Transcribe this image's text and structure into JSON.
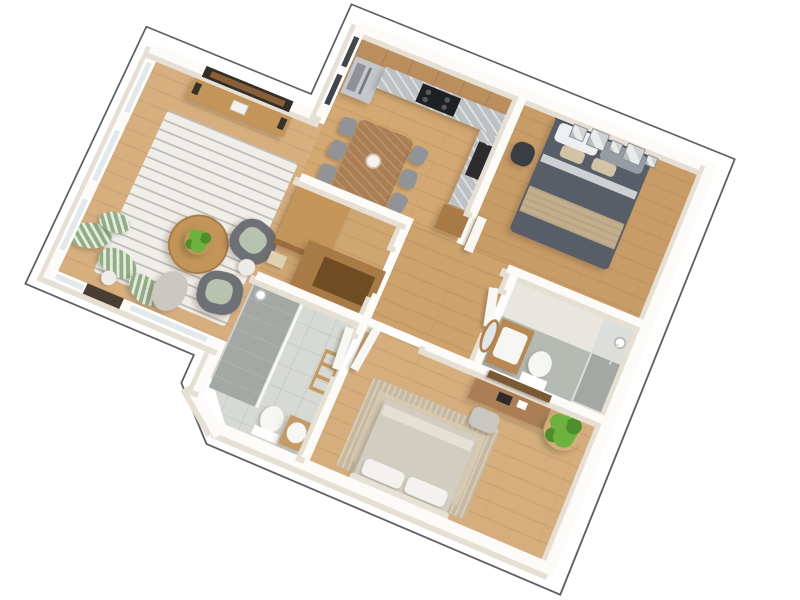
{
  "scene": {
    "type": "isometric-3d-floorplan-render",
    "description": "3D cutaway floor plan of a two-bedroom apartment viewed from above, white walls and oak floors on a plain white background, thin gray outline offset around the building perimeter",
    "view": {
      "plan_rotation_deg": 23,
      "tilt_deg": 12
    },
    "text_labels": []
  },
  "colors": {
    "outline": "#54575b",
    "wall": "#fcfbf8",
    "wall_shade": "#e6dfd4",
    "floor_living": "#d7af7f",
    "floor_kitchen": "#d3a872",
    "floor_hall": "#cda26d",
    "floor_master": "#c89c66",
    "floor_bed2": "#d6ae7d",
    "floor_closet": "#cfa671",
    "tile_light": "#d7d9d4",
    "tile_gray": "#b5bab3",
    "shower_tile": "#a3a8a4",
    "counter_marble": "#bdc1c4",
    "steel": "#c4c7cc",
    "steel_dark": "#8e9298",
    "cooktop": "#1f2022",
    "sink_black": "#2c2c2f",
    "cabinet_wood": "#bb8e5d",
    "wood_mid": "#c39558",
    "wood_deep": "#a87a45",
    "wood_dark": "#6f4c22",
    "table_wood": "#ab7e53",
    "chair_gray": "#909398",
    "rug_living": "#f0eee9",
    "rug_stripe": "#bfbeba",
    "armchair": "#6d7175",
    "cushion_sage": "#b7c3ae",
    "plant_sage": "#8fae85",
    "plant_sage_light": "#e6eadf",
    "pampas": "#cbc8c2",
    "plant_green": "#6db23f",
    "plant_green_dark": "#4e8f2c",
    "bed_master": "#585e67",
    "pillow_gray": "#969ca4",
    "pillow_white": "#edeff0",
    "sheet": "#cdd1d4",
    "blanket": "#c2ad8c",
    "blanket_light": "#d3c3a6",
    "bed2": "#d2ccc1",
    "bed2_fold": "#e5dfd4",
    "pillow2": "#f4f2ee",
    "headboard2": "#e8e2d6",
    "rug2": "#d6cab2",
    "rug2_border": "#c7b99f",
    "porcelain": "#f6f6f3",
    "vanity_wood": "#b88852",
    "mirror_wood": "#b2804a",
    "shelf_dark": "#7a5a33",
    "glass": "#dfe6e8",
    "window_glass": "#e3e9ea",
    "window_dark": "#41464c",
    "door_white": "#f8f7f4",
    "door_dark": "#4a3e33",
    "ladder_wood": "#c69a63",
    "mat_gray": "#c9c7c2",
    "desk_item": "#2e2c29",
    "accent_chair_dark": "#3a3d41"
  },
  "rooms": [
    {
      "id": "living-room",
      "position": "left wing",
      "features": [
        "panoramic windows on two exterior walls",
        "dark entrance opening in lower wall",
        "recessed tv niche in top wall"
      ],
      "furniture": [
        "striped area rug",
        "round wood coffee table with green plant",
        "two dark gray tub armchairs with sage cushions",
        "wood tv console with speakers",
        "three striped sage bushes",
        "small sage bush",
        "gray pampas plant",
        "white planter pot",
        "small white side table"
      ]
    },
    {
      "id": "kitchen-dining",
      "position": "top center",
      "furniture": [
        "wood upper cabinet run",
        "stainless refrigerator",
        "marble countertop",
        "black cooktop",
        "black inset sink",
        "wood base cabinet",
        "rectangular dining table with white flower vase",
        "six gray dining chairs"
      ]
    },
    {
      "id": "master-bedroom",
      "position": "top right",
      "furniture": [
        "dark gray double bed",
        "white and gray pillows",
        "beige throw blanket",
        "five gallery picture frames above headboard",
        "dark accent chair"
      ]
    },
    {
      "id": "ensuite-bathroom",
      "position": "right middle",
      "furniture": [
        "wood vanity with white sink",
        "oval wood framed mirror",
        "toilet",
        "walk-in shower with pole shower head",
        "gray tile floor zone"
      ]
    },
    {
      "id": "hallway",
      "position": "center",
      "furniture": [
        "white interior doors"
      ]
    },
    {
      "id": "walk-in-closet",
      "position": "center left",
      "furniture": [
        "tall wood wardrobe",
        "l-shaped wood storage unit",
        "light storage box"
      ]
    },
    {
      "id": "main-bathroom",
      "position": "bottom center-left",
      "features": [
        "chamfered exterior corner"
      ],
      "furniture": [
        "walk-in shower with glass partition",
        "shower head",
        "toilet",
        "white basin on wood stand",
        "wood ladder towel rack"
      ]
    },
    {
      "id": "second-bedroom",
      "position": "bottom right",
      "furniture": [
        "double bed with light beige duvet",
        "two white pillows",
        "chunky beige bordered rug",
        "wood desk with black laptop",
        "gray desk chair",
        "dark wood wall shelf",
        "bright green potted plant",
        "white door"
      ]
    }
  ],
  "counts": {
    "living_room_left_windows": 3,
    "living_room_bottom_windows": 2,
    "kitchen_exterior_windows": 2,
    "dining_chairs": 6,
    "picture_frames": 5,
    "armchairs": 2,
    "doors_white": 5
  }
}
